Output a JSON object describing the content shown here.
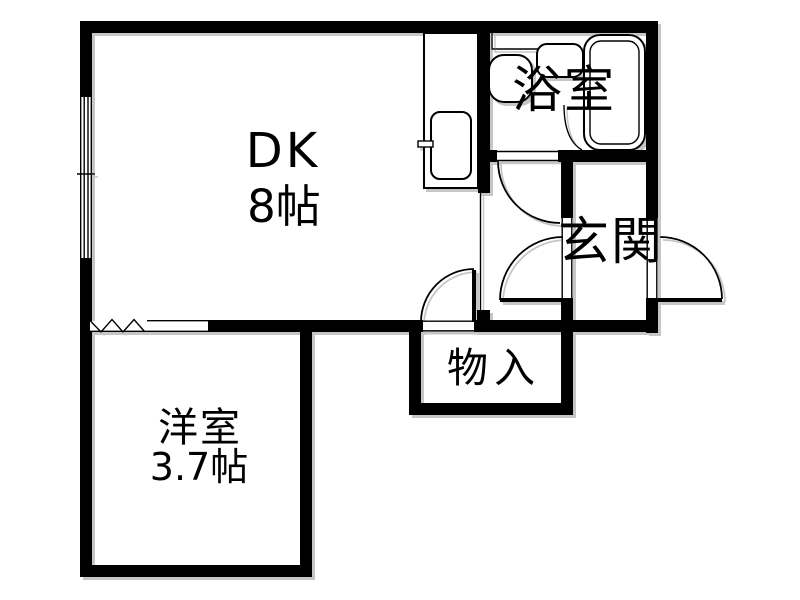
{
  "plan": {
    "kind": "apartment-floor-plan",
    "rooms": {
      "dk": {
        "label": "DK",
        "size": "8帖"
      },
      "bathroom": {
        "label": "浴室"
      },
      "entrance": {
        "label": "玄関"
      },
      "storage": {
        "label": "物入"
      },
      "western_room": {
        "label": "洋室",
        "size": "3.7帖"
      }
    },
    "colors": {
      "wall": "#000000",
      "line": "#000000",
      "background": "#ffffff",
      "shadow": "#c0c0c0"
    }
  }
}
